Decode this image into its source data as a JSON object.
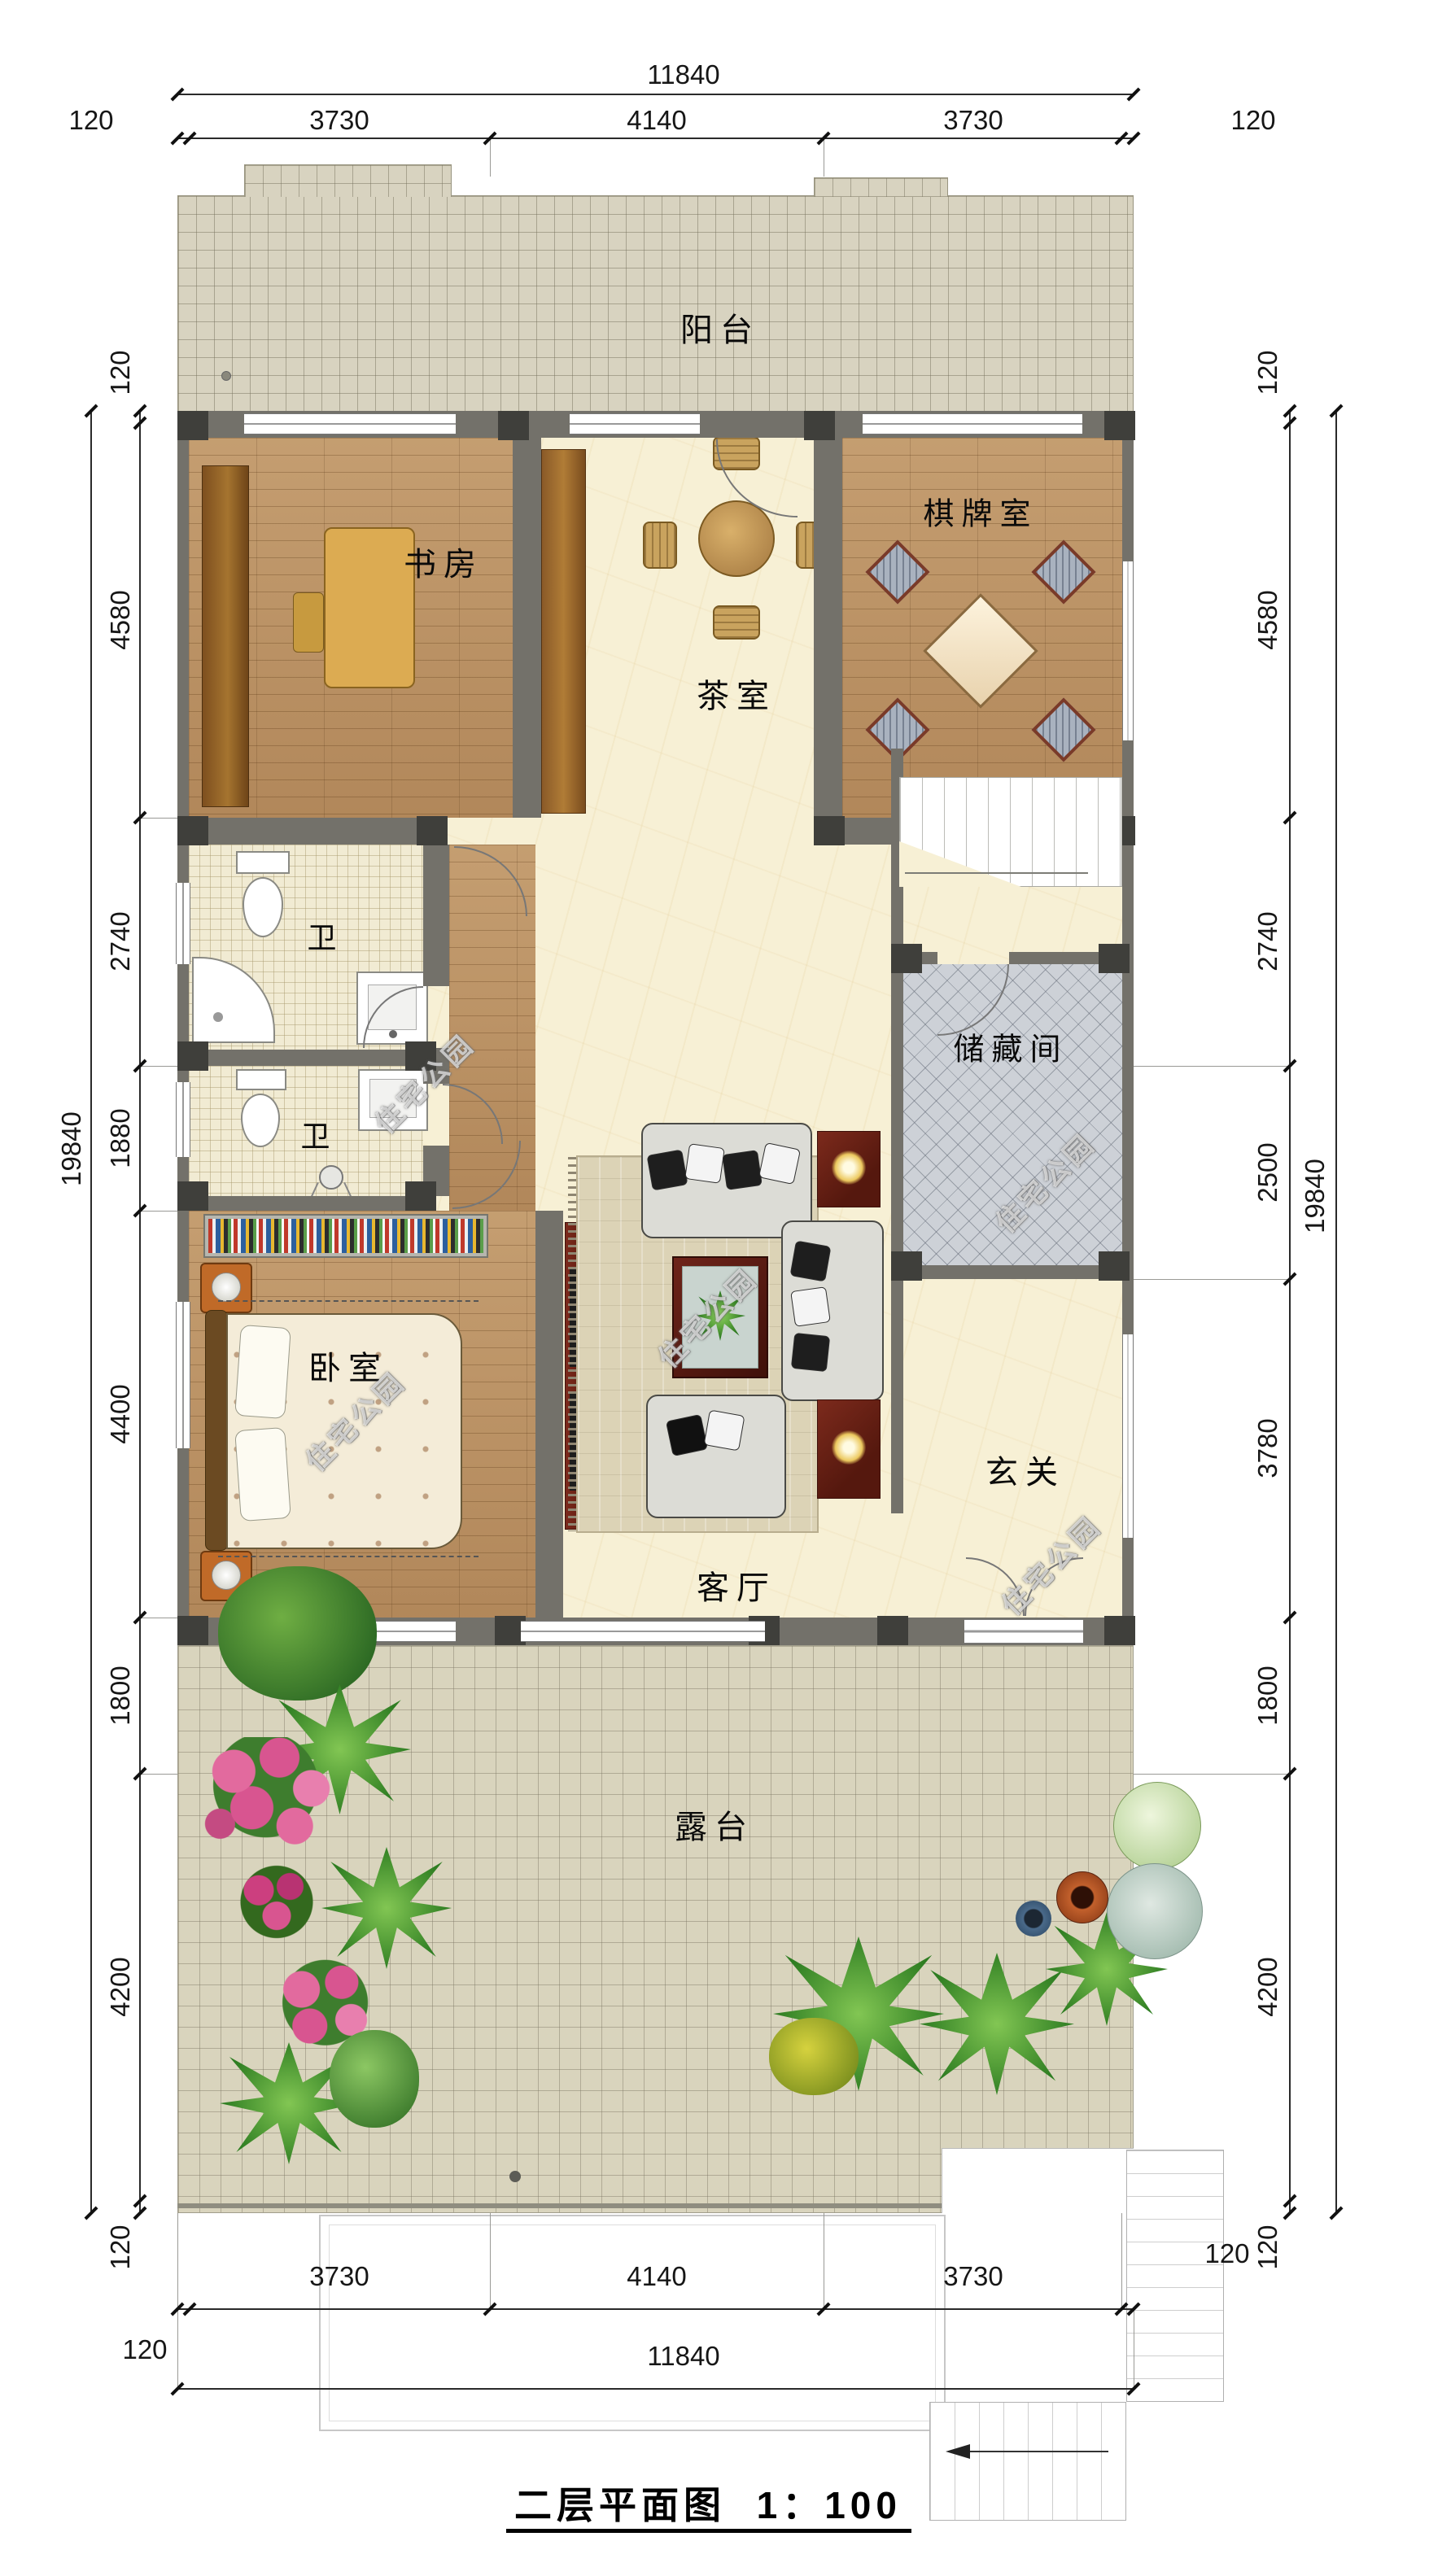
{
  "title": {
    "text": "二层平面图",
    "scale": "1：100"
  },
  "watermark": "住宅公园",
  "rooms": {
    "balcony": "阳台",
    "study": "书房",
    "tea": "茶室",
    "chess": "棋牌室",
    "bath1": "卫",
    "bath2": "卫",
    "storage": "储藏间",
    "bedroom": "卧室",
    "living": "客厅",
    "foyer": "玄关",
    "terrace": "露台"
  },
  "dimensions": {
    "top_total": [
      "11840"
    ],
    "top_chain": [
      "120",
      "3730",
      "4140",
      "3730",
      "120"
    ],
    "left_total": [
      "19840"
    ],
    "left_chain": [
      "120",
      "4580",
      "2740",
      "1880",
      "4400",
      "1800",
      "4200",
      "120"
    ],
    "right_total": [
      "19840"
    ],
    "right_chain": [
      "120",
      "4580",
      "2740",
      "2500",
      "3780",
      "1800",
      "4200",
      "120"
    ],
    "bottom_chain": [
      "3730",
      "4140",
      "3730"
    ],
    "bottom_total": [
      "11840"
    ],
    "bottom_left_offset": "120",
    "bottom_right_offset": "120"
  }
}
